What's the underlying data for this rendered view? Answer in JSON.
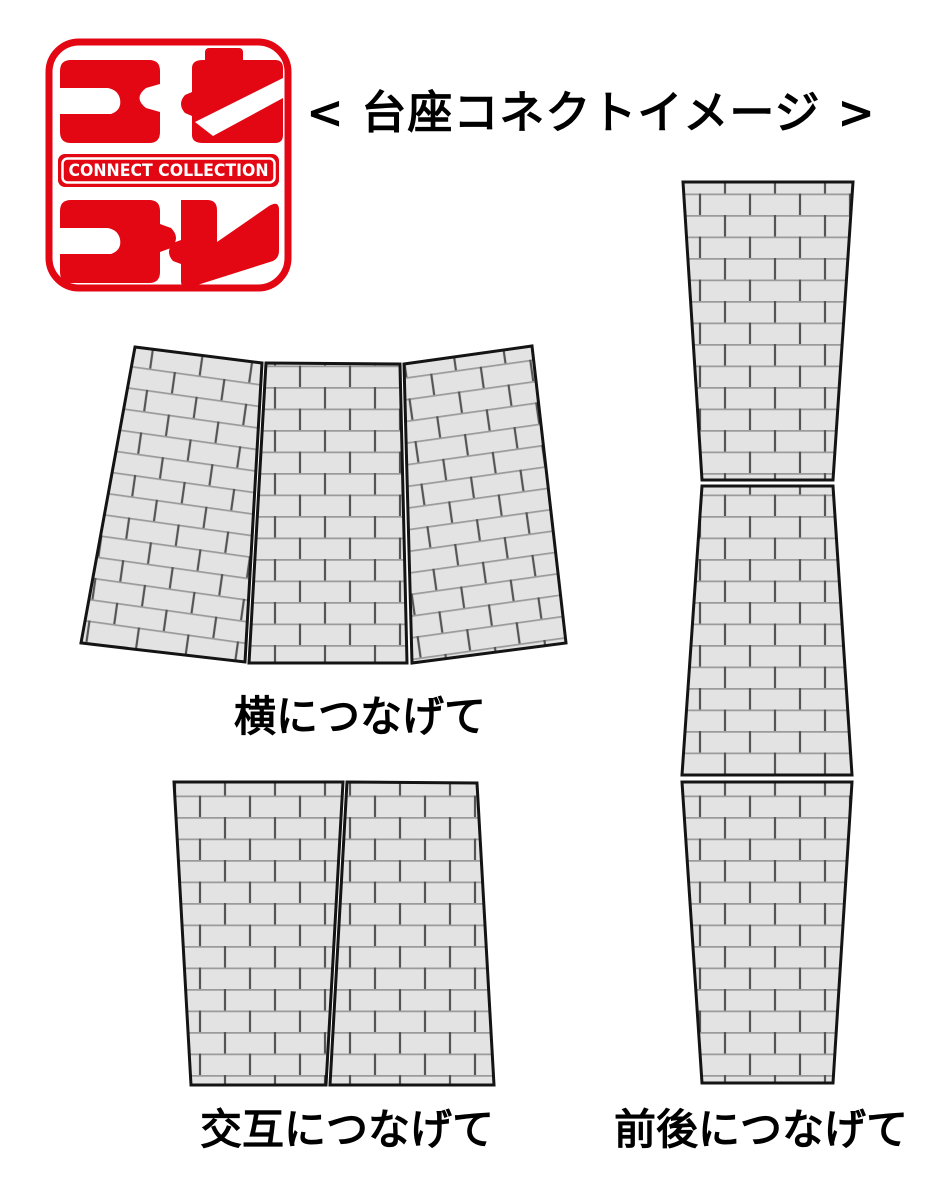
{
  "page": {
    "background": "#ffffff"
  },
  "logo": {
    "brand_color": "#e30613",
    "glyph_top_left": "コ",
    "glyph_top_right": "ネ",
    "glyph_bottom_left": "コ",
    "glyph_bottom_right": "レ",
    "band_text": "CONNECT COLLECTION",
    "series_name": "コネクレ"
  },
  "title": "< 台座コネクトイメージ >",
  "sections": {
    "horizontal": {
      "label": "横につなげて",
      "panel_count": 3,
      "arrangement": "fan-arc"
    },
    "alternate": {
      "label": "交互につなげて",
      "panel_count": 2,
      "arrangement": "alternating-flip"
    },
    "front_back": {
      "label": "前後につなげて",
      "panel_count": 3,
      "arrangement": "vertical-stack"
    }
  },
  "style": {
    "brick_fill": "#e3e3e3",
    "mortar_horizontal": "#9b9b9b",
    "mortar_vertical": "#555555",
    "outline": "#141414"
  }
}
